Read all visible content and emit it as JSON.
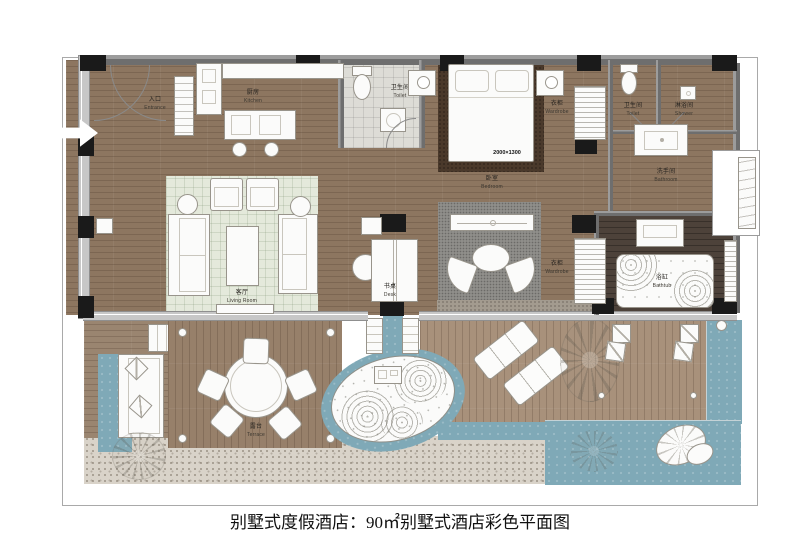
{
  "caption": "别墅式度假酒店：90㎡别墅式酒店彩色平面图",
  "rooms": {
    "entrance": {
      "zh": "入口",
      "en": "Entrance"
    },
    "kitchen": {
      "zh": "厨房",
      "en": "Kitchen"
    },
    "toilet_main": {
      "zh": "卫生间",
      "en": "Toilet"
    },
    "bedroom": {
      "zh": "卧室",
      "en": "Bedroom"
    },
    "wardrobe_bedroom": {
      "zh": "衣柜",
      "en": "Wardrobe"
    },
    "toilet_ensuite": {
      "zh": "卫生间",
      "en": "Toilet"
    },
    "shower": {
      "zh": "淋浴间",
      "en": "Shower"
    },
    "bathroom": {
      "zh": "洗手间",
      "en": "Bathroom"
    },
    "bathtub": {
      "zh": "浴缸",
      "en": "Bathtub"
    },
    "living_room": {
      "zh": "客厅",
      "en": "Living Room"
    },
    "desk": {
      "zh": "书桌",
      "en": "Desk"
    },
    "wardrobe_hall": {
      "zh": "衣柜",
      "en": "Wardrobe"
    },
    "terrace": {
      "zh": "露台",
      "en": "Terrace"
    }
  },
  "annotations": {
    "bed_size": "2000×1300"
  },
  "colors": {
    "wood_floor": "#8d7660",
    "deck_wood": "#a8917b",
    "terrace_wood": "#97806a",
    "water": "#7fa9b7",
    "bedroom_rug": "#4a392b",
    "living_rug": "#e4e9db",
    "seating_rug": "#8f8e8a",
    "gravel": "#d9d3c9",
    "bath_floor": "#4d423a",
    "wall": "#6e6e6e",
    "column": "#1a1a1a",
    "furniture": "#fbfbfa"
  }
}
